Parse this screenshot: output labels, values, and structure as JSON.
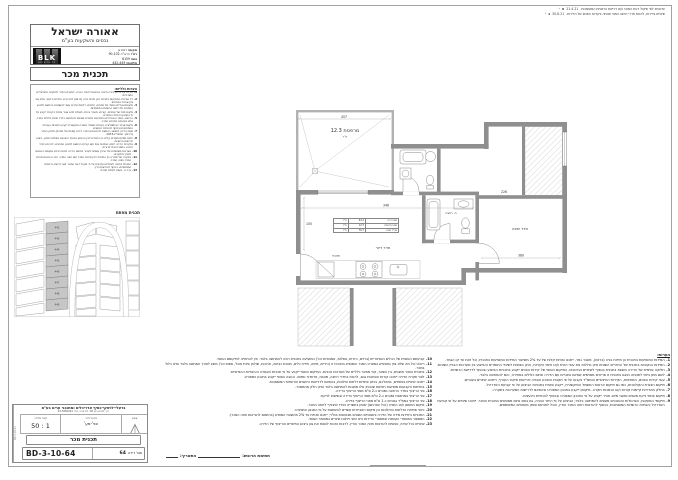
{
  "revisions": [
    {
      "text": "עדכונים לפי שיקול דעת המוכר ו/או דרישת הרשויות המוסמכות.",
      "date": "21.4.21",
      "letter": "א",
      "mark": "▵"
    },
    {
      "text": "שינויים בדירות, לרבות חדרי רחצה ושינוי תנוחה בקירות הפנים של הדירות.",
      "date": "30.6.21",
      "letter": "ב",
      "mark": "▵"
    }
  ],
  "header": {
    "company": "אאורה ישראל",
    "company_sub": "נכסים והשקעות בע\"מ",
    "location_label": "מקום:",
    "location": "רמת גן",
    "street_label": "רח':",
    "street": "הרא\"ה 90-102",
    "block_label": "גוש:",
    "block": "6159",
    "parcels_label": "חלקות:",
    "parcels": "442-449",
    "logo": "BLK",
    "logo_sub": "ARCHITECTS",
    "doc_title": "תכנית מכר"
  },
  "general_notes": {
    "title": "הערות כלליות:",
    "items": [
      {
        "num": "1.",
        "text": "הדירה על כל מרכיביה תיבנה בהתאם להיתר הבניה, למפרט המכר ולתקנים הישראליים המחייבים."
      },
      {
        "num": "2.",
        "text": "כל המידות המופיעות בתכנית הינן מידות בניה (ברוטו) לפני טיח, חיפויים וריצוף, אלא אם צוין אחרת במפורש."
      },
      {
        "num": "3.",
        "text": "מיקומם וגודלם הסופי של פתחים, חלונות, דלתות ופירים עשוי להשתנות בהתאם לתכנון המפורט ולדרישות הרשויות המוסמכות."
      },
      {
        "num": "4.",
        "text": "מיקום סופי של עמודים, קורות, מעברי צנרת, תעלות מיזוג אוויר ופתחי ביקורת ייקבע על פי התכנון ההנדסי המפורט."
      },
      {
        "num": "5.",
        "text": "הריהוט, הציוד והאביזרים המופיעים בתכנית מוצגים להמחשה בלבד ואינם כלולים במכר, אלא אם צוינו במפרט המכר."
      },
      {
        "num": "6.",
        "text": "מיקום אביזרי אינסטלציה, נקודות חשמל, תאורה ותקשורת ייקבע בתכניות העבודה המפורטות ובכפוף להנחיות היועצים."
      },
      {
        "num": "7.",
        "text": "שטח הדירה מחושב בהתאם להוראות צו מכר דירות (טופס של מפרט) ולחוק המכר (דירות), התשל\"ג-1973."
      },
      {
        "num": "8.",
        "text": "ייתכנו סטיות ושינויים קלים בין התכנית לבין הביצוע בפועל הנובעים מאילוצי תכנון, ביצוע ודרישות הרשויות."
      },
      {
        "num": "9.",
        "text": "בתקרות הדירה ייתכנו הנמכות גבס ו/או קורות בהתאם לתכנון המפורט, לרבות בחדרי רחצה, במטבח ובפרוזדורים."
      },
      {
        "num": "10.",
        "text": "מערכות משותפות של הבניין עשויות לעבור בתחום הדירה ויכוסו בכיסוי אקוסטי בהתאם לצורך ולתקנים."
      },
      {
        "num": "11.",
        "text": "במקרה של סתירה בין התכנית לבין מפרט המכר ו/או חוזה המכר, יגברו הוראות מפרט המכר וחוזה המכר."
      },
      {
        "num": "12.",
        "text": "התכנית כפופה לשינויים ועדכונים על פי שיקול דעת המוכר ו/או דרישת הרשויות המוסמכות, בכפוף להוראות הדין."
      },
      {
        "num": "13.",
        "text": "ט.ל.ח - טעות לעולם חוזרת."
      }
    ]
  },
  "key_plan": {
    "title": "תכנית מפתח",
    "parcels": [
      "442",
      "443",
      "444",
      "445",
      "446",
      "447",
      "448",
      "449"
    ]
  },
  "title_block": {
    "firm": "ברעלי-לויצקי-כסיף אדריכלים ומתכנני ערים בע\"מ",
    "firm_address": "דרך מנחם בגין 48, תל אביב. טל: 03-5660061",
    "north_label": "צפון:",
    "direction_label": "כיוון דירה:",
    "direction": "צפ'-מע'",
    "scale_label": "קנה מידה:",
    "scale": "1 : 50",
    "doc_name": "תכנית מכר",
    "apt_label": "מס' דירה",
    "apt_number": "64",
    "drawing_number": "BD-3-10-64",
    "side_text": "BD-3-10-64"
  },
  "plan": {
    "balcony": {
      "label": "מרפסת 12.3",
      "unit": "מ\"ר"
    },
    "rooms": {
      "living": "חדר דיור",
      "kitchen": "מטבח",
      "bath": "ח. רחצה",
      "bedroom": "חדר שינה"
    },
    "dims": {
      "top": "457",
      "living": "346",
      "bedroom": "380",
      "hall": "226",
      "side": "105"
    },
    "area_table": {
      "rows": [
        [
          "שטח דירה",
          "64.4",
          "מ\"ר"
        ],
        [
          "שטח מרפסת",
          "12.3",
          "מ\"ר"
        ],
        [
          "סה\"כ שטח",
          "76.7",
          "מ\"ר"
        ]
      ]
    }
  },
  "bottom_notes": {
    "items": [
      {
        "num": "10.",
        "text": "קביעתם הסופית של הכלים הסניטריים (ברזים, כיורים, אסלות, אמבטיות וכו') המופיעה בתכנית הינה להמחשה בלבד. אין להתחייב למיקומם הסופי."
      },
      {
        "num": "11.",
        "text": "ריהוט וכל מה שלא צוין במפורש במפרט המכר והמופיע בתכנית זו (כיריים, מיטה, מדיח כלים, מכונת כביסה, ארונות, שולחן פינת אוכל, ספות וכו') מוצג לצורך המחשה בלבד ואינו כלול במכר."
      },
      {
        "num": "12.",
        "text": "בתכנית המכר מוצגים, בין השאר, קווי מתאר כלליים של מערכות טכניות. המיקום הסופי ייקבע על פי תכניות העבודה וההנחיות ההנדסיות."
      },
      {
        "num": "13.",
        "text": "לפני תקרת הדירה ייתכנו קורות והנמכות גבס, לרבות בחדרי רחצה, מטבח, פרוזדור ומזווה. הגובה הסופי ייקבע בתכנון המפורט."
      },
      {
        "num": "14.",
        "text": "ייתכנו שינויים בפתחים, במהלכם, בכיוון פתיחת דלתות וחלונות, בהתאם לדרישות היועצים והרשויות המוסמכות."
      },
      {
        "num": "15.",
        "text": "בחזיתות הקבועות מופיעות חזיתות שכנות; אלו מוצגות להמחשה בלבד ואינן חלק מהממכר."
      },
      {
        "num": "16.",
        "text": "פני הריצוף בחדר הרחצה נמוכים כ-2 ס\"מ מפני הריצוף בדירה."
      },
      {
        "num": "17.",
        "text": "פני הריצוף במרפסת נמוכים כ-2 ס\"מ מפני הריצוף בדירה ובשיפוע לניקוז."
      },
      {
        "num": "18.",
        "text": "פני הריצוף בממ\"ד גבוהים כ-1 ס\"מ מפני הריצוף בדירה."
      },
      {
        "num": "19.",
        "text": "מיקום המחסן ו/או החניה (ככל שנרכשו) יסומן בתשריט נפרד שיצורף לחוזה המכר."
      },
      {
        "num": "20.",
        "text": "כיווני פתיחת הדלתות והחלונות וכן מיקום האביזרים עשויים להשתנות על פי התכנון המפורט."
      },
      {
        "num": "21.",
        "text": "התכניות ביחידות מידה של הדירה והשטחים השונים מבוטאות במ\"ר; ייתכנו סטיות עד 2% מהשטח המופיע (בהתאם להוראות חוזה המכר)."
      },
      {
        "num": "22.",
        "text": "המספור במספרי הקומות ובמספרי הדירות הינו זמני וייתכנו שינויים במספור הסופי."
      },
      {
        "num": "23.",
        "text": "שינויים ככל שיהיו, כפופים להוראות חוזה המכר והדין. לרבות הזכות לשנות את גוון ביצוע החיפויים והריצוף של הדירה."
      }
    ]
  },
  "right_notes": {
    "title": "הערות:",
    "items": [
      {
        "num": "1.",
        "text": "המידות המופיעות בתכנית הן מידות בניה (ברוטו), מעבר גמר. ייתכנו סטיות קלות של עד 2% משיעור המידות המופיעות בתכנית, וכל זאת עד קו הגמר."
      },
      {
        "num": "2.",
        "text": "המידות הנקובות בתכנית של החדרים השונים אינן כוללות את עובי הטיח ו/או חיפוי הקירות, והינן כפופות לשינויי החומרים והביצוע בין מערכות הבניין השונות."
      },
      {
        "num": "3.",
        "text": "חלוקה פנימית של הדירה מוצגת בתכנית בכפוף לשינויים ועדכונים. המיקום הסופי של קירות הפנים ייקבע בתכניות הביצוע ובכפוף לדרישת הרשויות."
      },
      {
        "num": "4.",
        "text": "לשם מתן ביטוי לתנוחה הוצגו בתכנית זו פריטים מסוימים שאינם נמכרים עם הדירה ואינם כלולים במחירה, והם להמחשה בלבד."
      },
      {
        "num": "5.",
        "text": "עובי קירות הפנים, המחיצות, הקירות החיצוניים והממ\"ד נקבעו על פי תקנות התכנון והבניה ודרישות פיקוד העורף, וייתכנו שינויים בעוביים."
      },
      {
        "num": "6.",
        "text": "מיקום הצנרת והקולטנים, כמו גם מיקום ארונות החשמל והתקשורת, ייקבע סופית בתכניות הביצוע על פי קביעת האדריכל."
      },
      {
        "num": "7.",
        "text": "בחלק מהדירות קיימות קורות ו/או הנמכות תקרה. מיקומן ייקבע בתכנון המפורט ובהתאם לדרישות המערכות בתקרה."
      },
      {
        "num": "8.",
        "text": "מיקום פתחי ניקוז מזגנים ומעבי מיזוג אוויר ייקבע על פי התכנון המפורט ובכפוף להנחיות היועצים."
      },
      {
        "num": "9.",
        "text": "מיקומי המעקות, הפרגולות והסוככים מוצגים להמחשה בלבד; הביצוע על פי היתר הבניה, גם באם אינם מסומנים בתכנית המכר. ייתכנו שינויים על פי קביעת האדריכל והנחיות הרשויות המוסמכות, בכפוף להוראות חוזה המכר והדין, והכל למניעת ספק בשטחים המשותפים."
      }
    ]
  },
  "signature": {
    "buyer_label": "חתימת הרוכש:",
    "date_label": "התאריך:"
  }
}
